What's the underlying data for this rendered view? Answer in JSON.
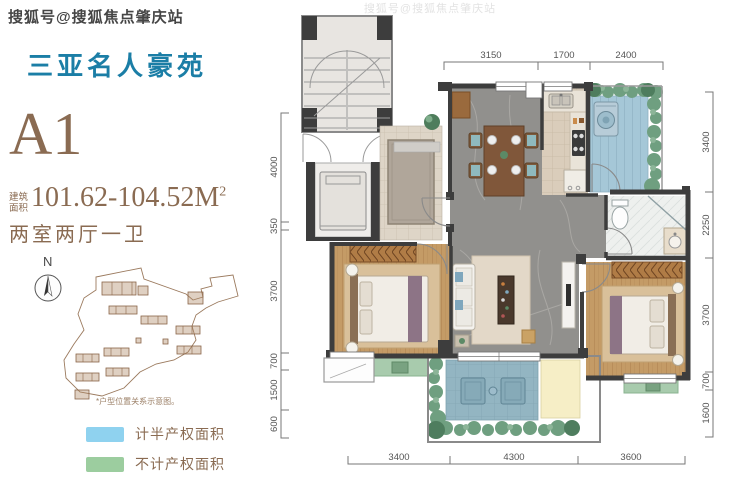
{
  "watermark": "搜狐号@搜狐焦点肇庆站",
  "title": "三亚名人豪苑",
  "unit": {
    "code": "A1",
    "area_prefix_top": "建筑",
    "area_prefix_bottom": "面积",
    "area_value": "101.62-104.52M",
    "area_sup": "2",
    "rooms": "两室两厅一卫"
  },
  "compass": {
    "north_label": "N"
  },
  "site_plan_note": "*户型位置关系示意图。",
  "legend": {
    "items": [
      {
        "label": "计半产权面积",
        "color": "#8fd2ef"
      },
      {
        "label": "不计产权面积",
        "color": "#9ccd9f"
      }
    ]
  },
  "floorplan": {
    "dimensions": {
      "top": [
        "3150",
        "1700",
        "2400"
      ],
      "right": [
        "3400",
        "2250",
        "3700",
        "700",
        "1600"
      ],
      "left": [
        "4000",
        "350",
        "3700",
        "700",
        "1500",
        "600"
      ],
      "bottom": [
        "3400",
        "4300",
        "3600"
      ]
    }
  },
  "colors": {
    "title_teal": "#1b7ea6",
    "text_brown": "#8a6b52",
    "legend_blue": "#8fd2ef",
    "legend_green": "#9ccd9f",
    "wall_dark": "#3d3d3d",
    "marble_grey": "#91908d",
    "wood": "#c49b66",
    "terrace_blue": "#a5c7d7"
  }
}
